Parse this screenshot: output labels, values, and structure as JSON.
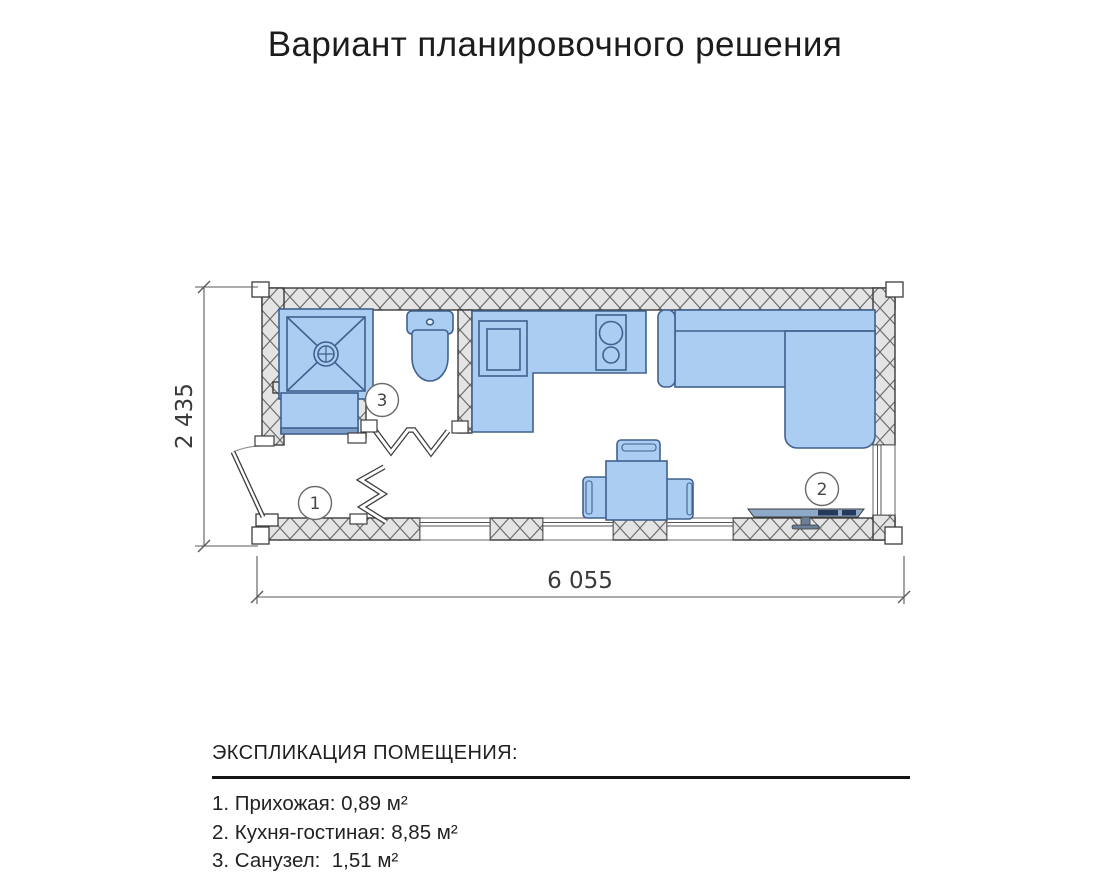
{
  "title": "Вариант планировочного решения",
  "plan": {
    "width_label": "6 055",
    "height_label": "2 435",
    "furniture": [
      "shower-tray",
      "washing-machine",
      "toilet",
      "entry-door",
      "folding-door",
      "kitchen-counter",
      "sink",
      "cooktop",
      "corner-sofa",
      "dining-table",
      "chair",
      "tv-on-stand",
      "window"
    ],
    "colors": {
      "furniture_fill": "#abcdf1",
      "furniture_stroke": "#40608f",
      "wall_fill": "#e4e4e4",
      "hatch_line": "#6a6a6a",
      "outline": "#3c3c3c"
    }
  },
  "rooms": [
    {
      "number": "1",
      "label": "1. Прихожая: 0,89 м²"
    },
    {
      "number": "2",
      "label": "2. Кухня-гостиная: 8,85 м²"
    },
    {
      "number": "3",
      "label": "3. Санузел:  1,51 м²"
    }
  ],
  "legend": {
    "header": "ЭКСПЛИКАЦИЯ ПОМЕЩЕНИЯ:"
  }
}
